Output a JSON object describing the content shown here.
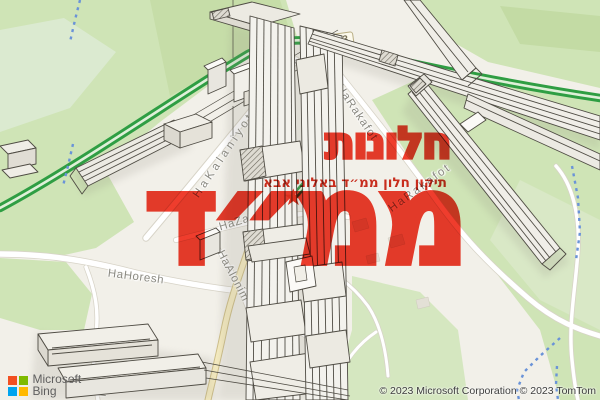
{
  "watermark": {
    "title_line1": "חלונות",
    "title_line2": "ממ״ד",
    "subtitle": "תיקון חלון ממ״ד באלוני אבא",
    "star": "★",
    "title_color": "#e6392c",
    "subtitle_color": "#c62b1c"
  },
  "map": {
    "road_shield": {
      "text": "513"
    },
    "street_labels": [
      {
        "text": "HaKalaniyot",
        "x": 224,
        "y": 155,
        "rot": -56,
        "ls": 3.5
      },
      {
        "text": "HaRakafot",
        "x": 357,
        "y": 113,
        "rot": 56,
        "ls": 1.2
      },
      {
        "text": "HaRakafot",
        "x": 420,
        "y": 188,
        "rot": -36,
        "ls": 2.2
      },
      {
        "text": "Hadarim",
        "x": 272,
        "y": 206,
        "rot": 73,
        "ls": 0.8
      },
      {
        "text": "HaZayit",
        "x": 241,
        "y": 221,
        "rot": -17,
        "ls": 0.8
      },
      {
        "text": "HaEgoz",
        "x": 287,
        "y": 241,
        "rot": 80,
        "ls": 0.6
      },
      {
        "text": "HaKramim",
        "x": 331,
        "y": 249,
        "rot": 72,
        "ls": 0.8
      },
      {
        "text": "HaAlonim",
        "x": 233,
        "y": 276,
        "rot": 62,
        "ls": 0.8
      },
      {
        "text": "HaHoresh",
        "x": 136,
        "y": 277,
        "rot": 7,
        "ls": 0.6
      },
      {
        "text": "laSh",
        "x": 104,
        "y": 384,
        "rot": -84,
        "ls": 0.5
      },
      {
        "text": "lok",
        "x": 148,
        "y": 371,
        "rot": -38,
        "ls": 0.5
      }
    ],
    "highway_color": "#2f9e43",
    "trail_color": "#6a93d8"
  },
  "attribution": {
    "copyright": "© 2023 Microsoft Corporation © 2023 TomTom",
    "logo_line1": "Microsoft",
    "logo_line2": "Bing",
    "logo_colors": [
      "#f25022",
      "#7fba00",
      "#00a4ef",
      "#ffb900"
    ]
  }
}
